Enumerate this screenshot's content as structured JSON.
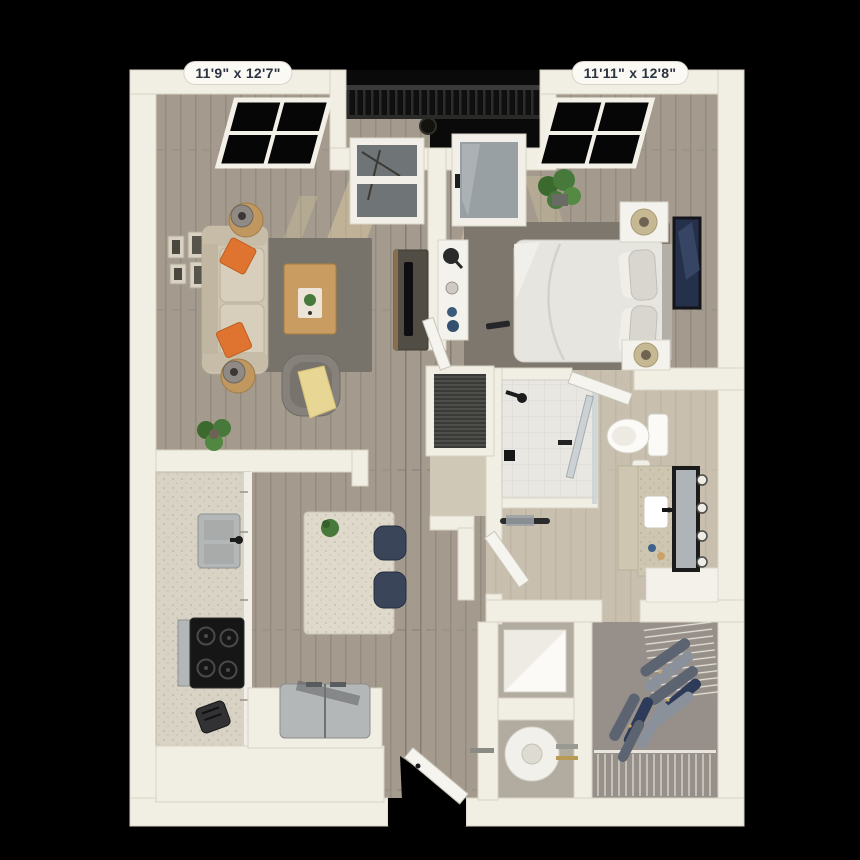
{
  "page": {
    "type": "3d-floor-plan-render",
    "background": "#000000"
  },
  "labels": {
    "living_room_dimensions": "11'9\" x 12'7\"",
    "bedroom_dimensions": "11'11\" x 12'8\""
  },
  "rooms": [
    {
      "name": "living-room",
      "dimensions": "11'9\" x 12'7\"",
      "furniture": [
        "sofa",
        "orange-throw-pillows",
        "side-tables-with-lamps",
        "coffee-table",
        "area-rug",
        "armchair-with-throw",
        "tv-console",
        "wall-art-frames",
        "potted-plant",
        "black-window",
        "balcony-window"
      ]
    },
    {
      "name": "bedroom",
      "dimensions": "11'11\" x 12'8\"",
      "furniture": [
        "bed",
        "nightstands-with-lamps",
        "desk",
        "area-rug",
        "wall-art",
        "potted-plant",
        "balcony-glass-door",
        "black-window"
      ]
    },
    {
      "name": "balcony",
      "furniture": [
        "metal-railing",
        "patio-chair"
      ]
    },
    {
      "name": "bathroom",
      "furniture": [
        "walk-in-shower",
        "toilet",
        "vanity-with-sink",
        "leaning-mirror",
        "towel-bar"
      ]
    },
    {
      "name": "walk-in-closet",
      "furniture": [
        "wire-shelving",
        "hanging-clothes"
      ]
    },
    {
      "name": "laundry-closet",
      "furniture": [
        "stacked-appliance"
      ]
    },
    {
      "name": "utility-closet",
      "furniture": [
        "water-heater"
      ]
    },
    {
      "name": "kitchen",
      "furniture": [
        "sink",
        "range-cooktop",
        "refrigerator",
        "island-with-plant",
        "bar-stools",
        "toaster",
        "counters"
      ]
    },
    {
      "name": "hallway",
      "furniture": [
        "louvered-hvac-closet"
      ]
    },
    {
      "name": "entry",
      "furniture": [
        "entry-door"
      ]
    }
  ],
  "colors": {
    "background": "#000000",
    "wall": "#f1eee3",
    "wall_edge": "#d7d3c4",
    "wood_floor": "#a49b8e",
    "bath_floor": "#c8bfae",
    "closet_floor": "#b2aba0",
    "walkin_floor": "#97908a",
    "tile_nook": "#cfc8b6",
    "balcony_floor": "#0a0a0a",
    "railing": "#161616",
    "rug_living": "#78736a",
    "rug_bedroom": "#7d776e",
    "sofa": "#cec5b2",
    "pillow_orange": "#de7430",
    "table_wood": "#c0975e",
    "armchair": "#86827b",
    "throw_yellow": "#e7d694",
    "tv_console": "#514d45",
    "bed_white": "#e7e5df",
    "linen_white": "#f4f2ec",
    "counter_speckle": "#d8d3c4",
    "island_top": "#ded9ca",
    "stool_navy": "#3b4559",
    "stainless": "#b4b7b8",
    "cooktop_black": "#161616",
    "plant_green": "#47793a",
    "art_navy": "#25304a",
    "glass": "#99a0a3",
    "porcelain": "#fbfaf6",
    "mirror_frame": "#1b1b1b",
    "vanity_speckle": "#cec6b1",
    "clothes_gray": "#5d6471",
    "clothes_light": "#8b919b",
    "clothes_navy": "#2e3a59",
    "sunlight": "#dcc9a0",
    "door_white": "#f6f4ee",
    "label_bg": "#fbf9f4",
    "label_text": "#2c3340"
  }
}
